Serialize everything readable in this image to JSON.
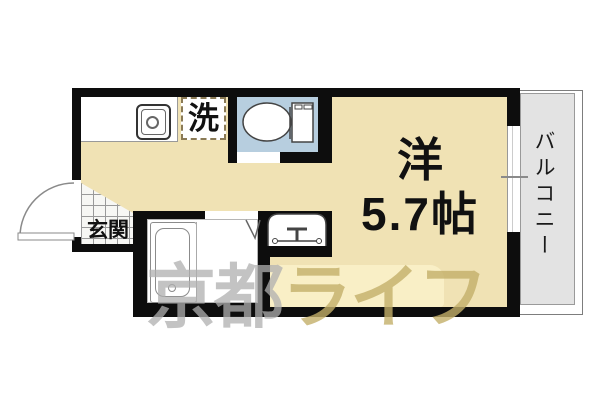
{
  "rooms": {
    "main": {
      "name_line1": "洋",
      "name_line2": "5.7帖"
    },
    "entrance": {
      "label": "玄関"
    },
    "laundry": {
      "label": "洗"
    },
    "balcony": {
      "label": "バルコニー"
    }
  },
  "watermark": {
    "part1": "京都",
    "part2": "ライフ"
  },
  "fixtures": [
    "kitchen-sink-icon",
    "washing-machine-space",
    "toilet-icon",
    "bathtub-icon",
    "wash-basin-icon",
    "entrance-door-swing",
    "bathroom-door-mark",
    "sliding-window"
  ],
  "colors": {
    "floor": "#f0e2b4",
    "wall": "#0d0d0d",
    "toilet_floor": "#b7cedf",
    "balcony_floor": "#e3e3e3",
    "laundry_dash": "#8a7a55",
    "watermark_box": "rgba(255,248,210,0.6)",
    "watermark_gray": "rgba(175,175,175,0.75)",
    "watermark_yellow": "rgba(195,175,105,0.8)"
  }
}
